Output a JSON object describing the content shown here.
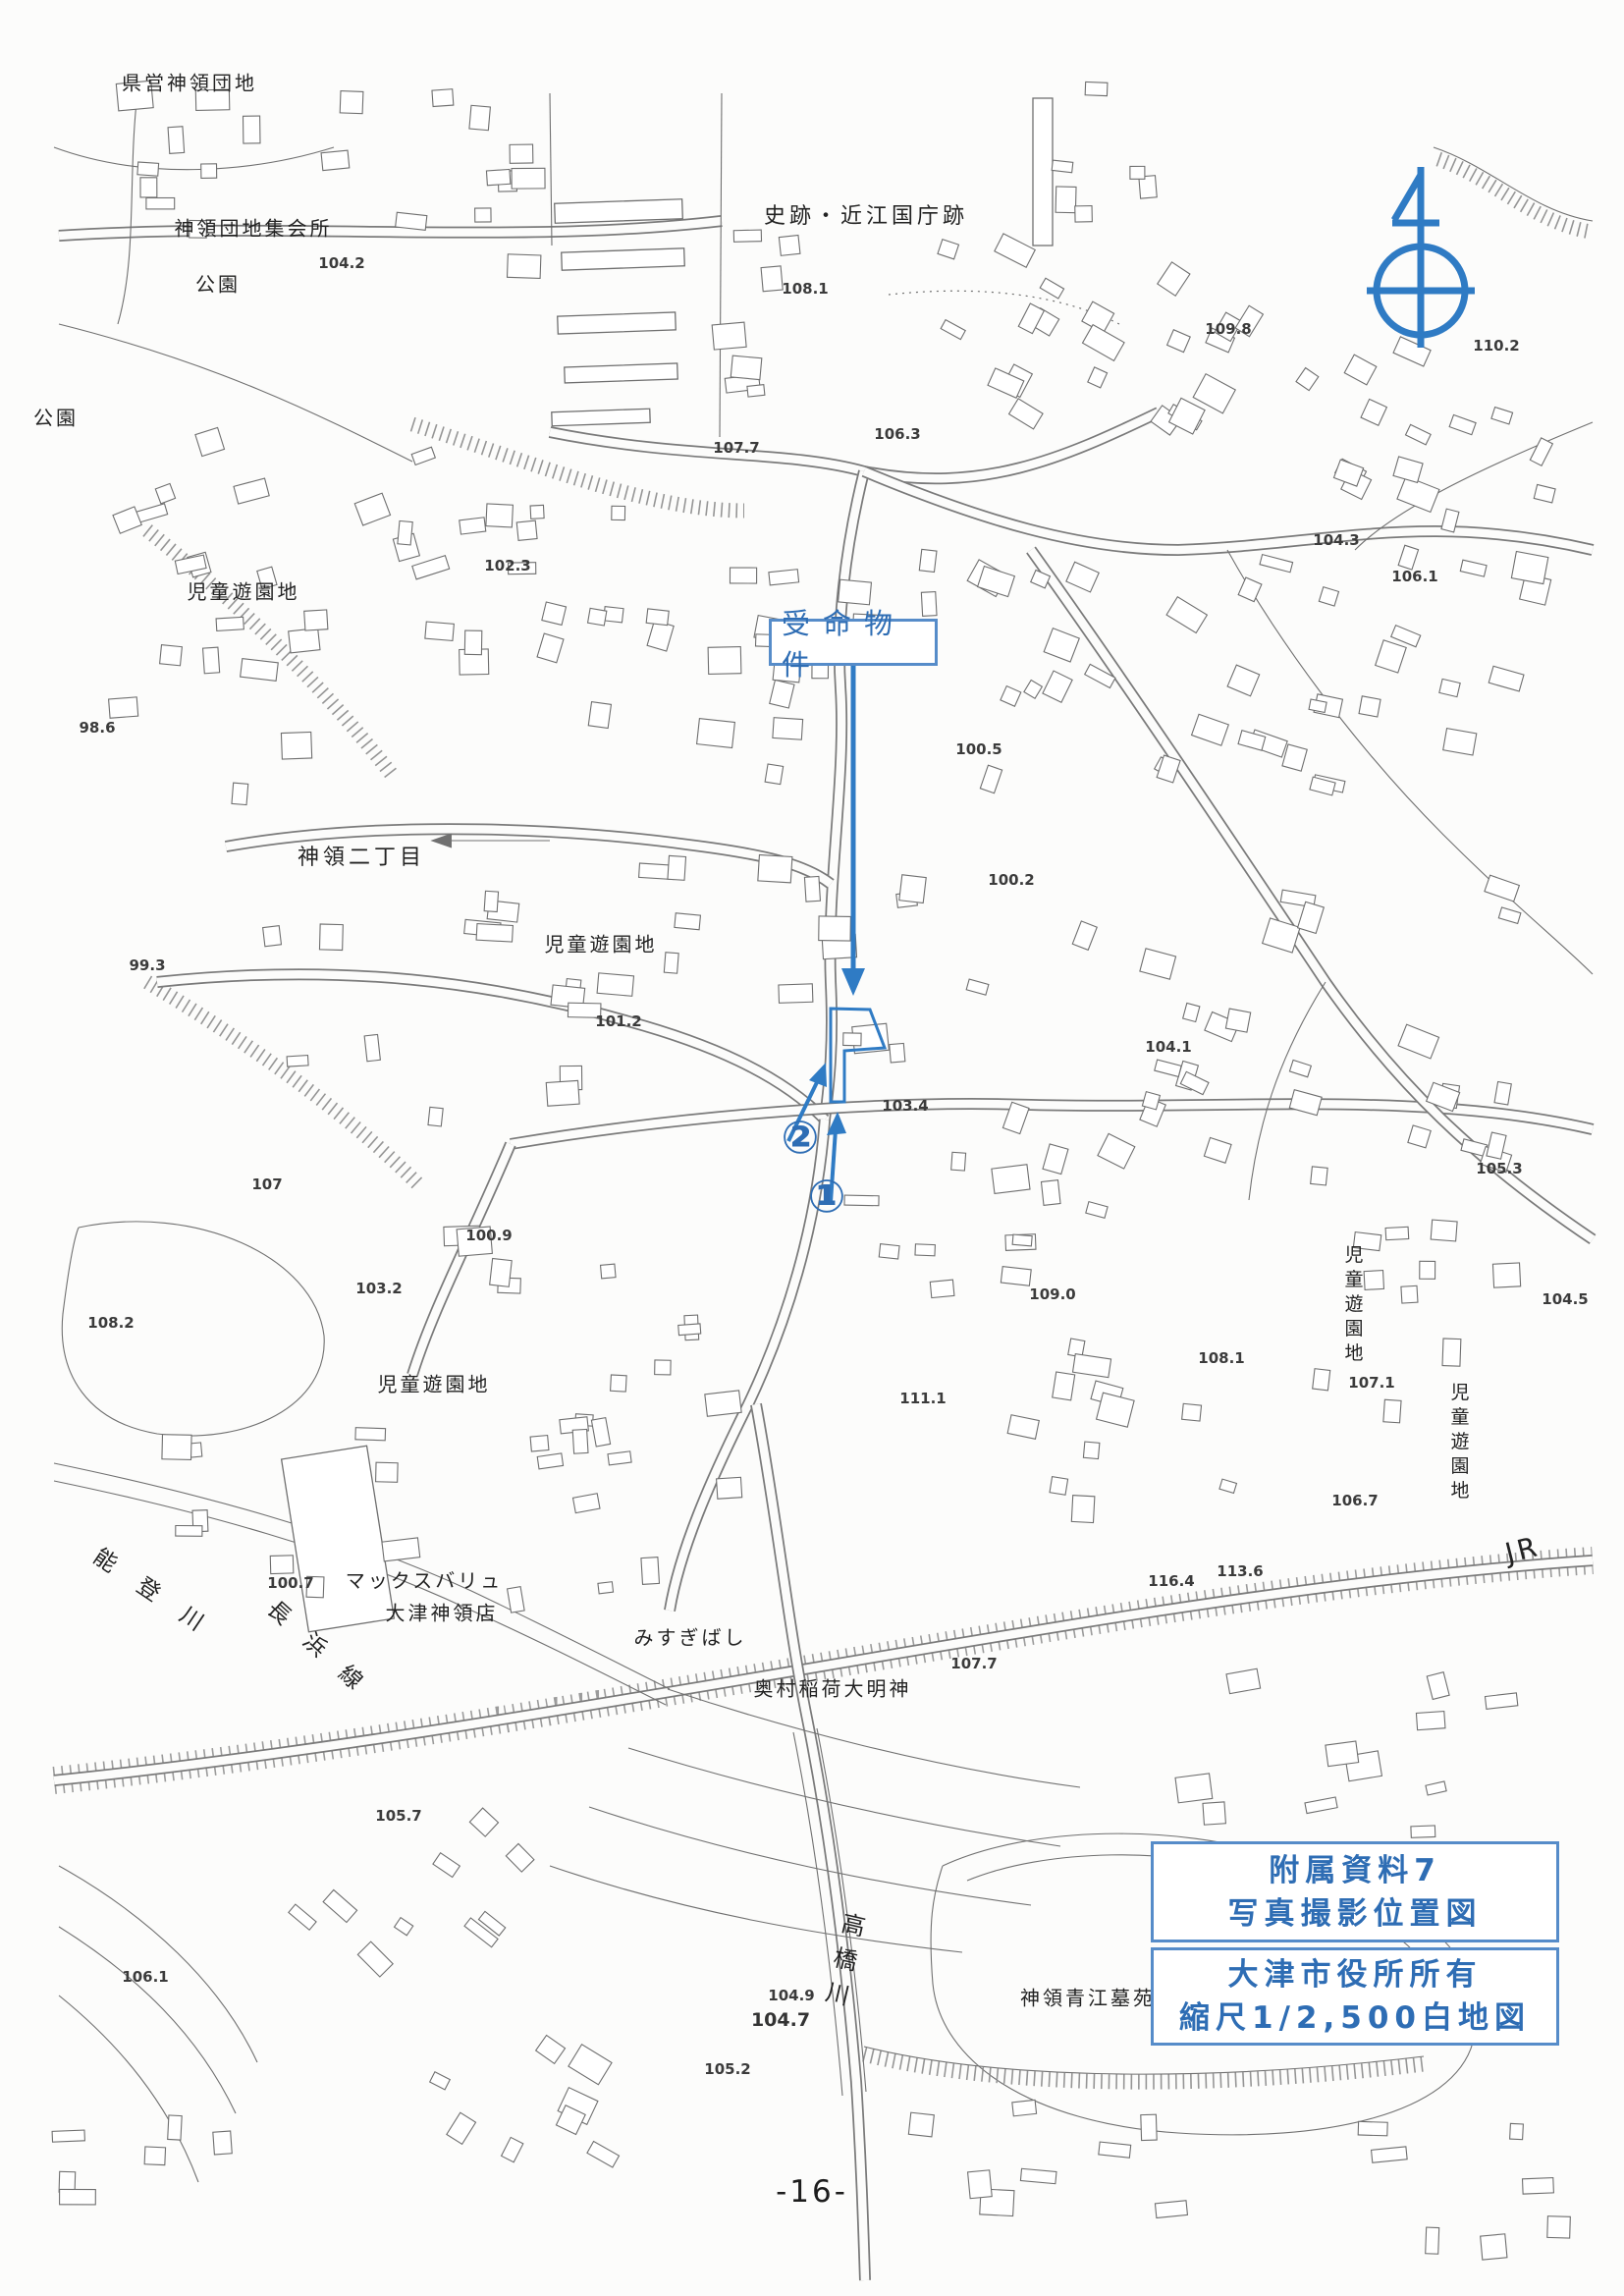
{
  "annotations": {
    "subject_label": "受命物件",
    "marker_1": "①",
    "marker_2": "②",
    "info_box_top": {
      "line1": "附属資料7",
      "line2": "写真撮影位置図"
    },
    "info_box_bottom": {
      "line1": "大津市役所所有",
      "line2": "縮尺1/2,500白地図"
    },
    "accent_color": "#2e6db4"
  },
  "page": {
    "number": "-16-"
  },
  "map_labels": [
    {
      "text": "県営神領団地"
    },
    {
      "text": "神領団地集会所"
    },
    {
      "text": "公園"
    },
    {
      "text": "公園"
    },
    {
      "text": "史跡・近江国庁跡"
    },
    {
      "text": "104.2"
    },
    {
      "text": "108.1"
    },
    {
      "text": "109.8"
    },
    {
      "text": "110.2"
    },
    {
      "text": "107.7"
    },
    {
      "text": "106.3"
    },
    {
      "text": "102.3"
    },
    {
      "text": "104.3"
    },
    {
      "text": "児童遊園地"
    },
    {
      "text": "106.1"
    },
    {
      "text": "98.6"
    },
    {
      "text": "100.5"
    },
    {
      "text": "神領二丁目"
    },
    {
      "text": "100.2"
    },
    {
      "text": "児童遊園地"
    },
    {
      "text": "99.3"
    },
    {
      "text": "101.2"
    },
    {
      "text": "104.1"
    },
    {
      "text": "103.4"
    },
    {
      "text": "105.3"
    },
    {
      "text": "107"
    },
    {
      "text": "100.9"
    },
    {
      "text": "103.2"
    },
    {
      "text": "108.2"
    },
    {
      "text": "109.0"
    },
    {
      "text": "104.5"
    },
    {
      "text": "108.1"
    },
    {
      "text": "111.1"
    },
    {
      "text": "児童遊園地"
    },
    {
      "text": "児童遊園地"
    },
    {
      "text": "107.1"
    },
    {
      "text": "児童遊園地"
    },
    {
      "text": "106.7"
    },
    {
      "text": "100.7"
    },
    {
      "text": "マックスバリュ"
    },
    {
      "text": "大津神領店"
    },
    {
      "text": "能登川"
    },
    {
      "text": "長浜線"
    },
    {
      "text": "116.4"
    },
    {
      "text": "113.6"
    },
    {
      "text": "JR"
    },
    {
      "text": "みすぎばし"
    },
    {
      "text": "奥村稲荷大明神"
    },
    {
      "text": "107.7"
    },
    {
      "text": "105.7"
    },
    {
      "text": "106.1"
    },
    {
      "text": "高橋川"
    },
    {
      "text": "神領青江墓苑"
    },
    {
      "text": "104.9"
    },
    {
      "text": "104.7"
    },
    {
      "text": "105.2"
    }
  ]
}
